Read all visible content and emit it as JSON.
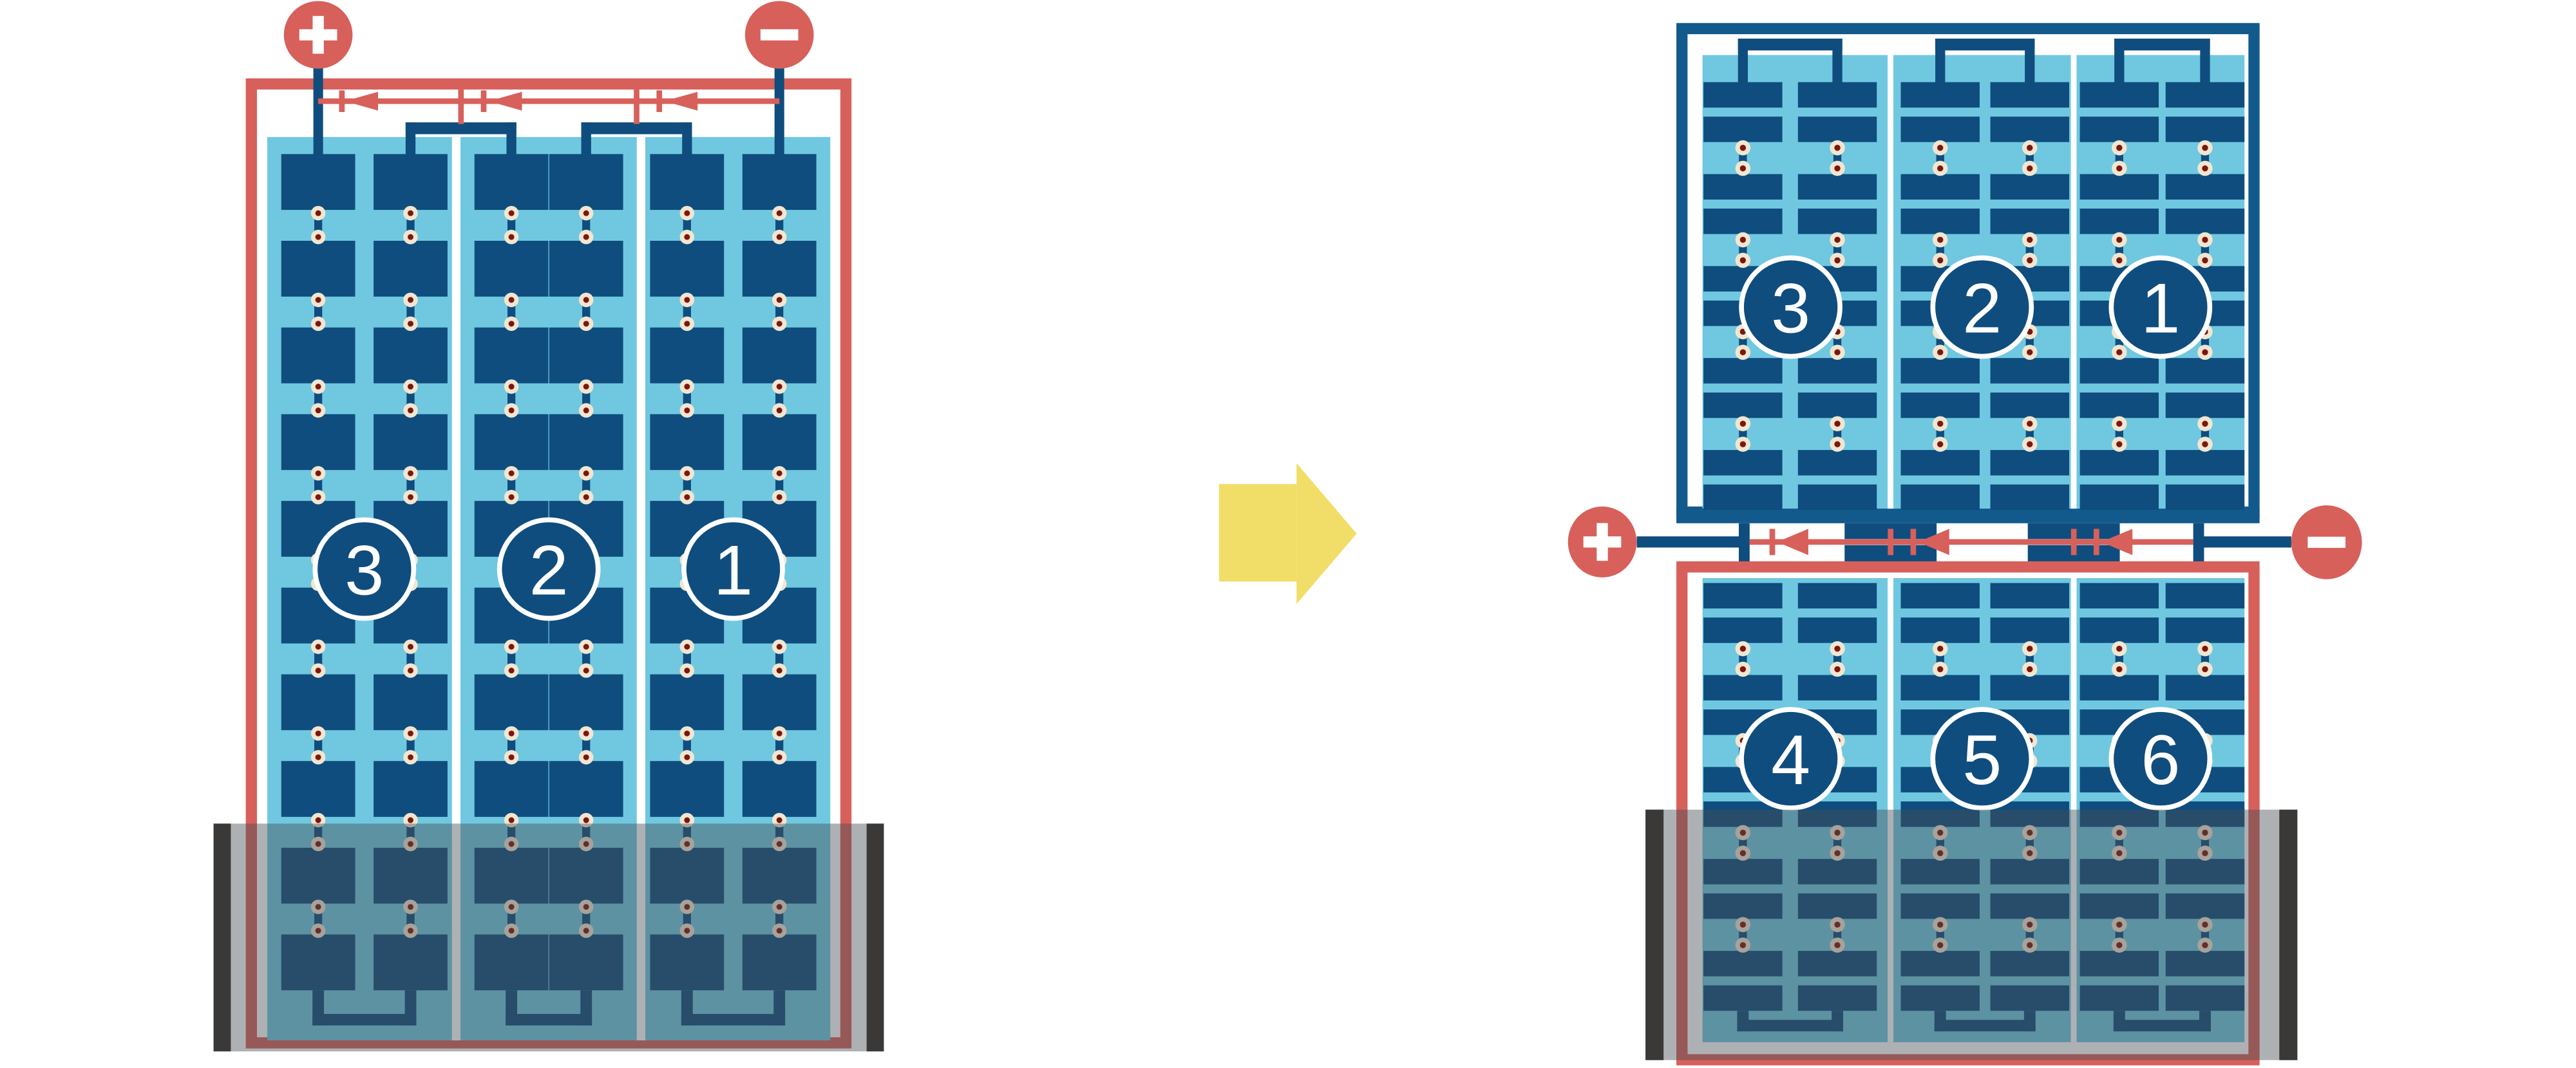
{
  "diagram_title": "",
  "terminals": {
    "positive_label": "+",
    "negative_label": "−",
    "positive_icon": "plus-icon",
    "negative_icon": "minus-icon"
  },
  "left_module": {
    "type": "full-cell-module",
    "substring_labels": [
      "3",
      "2",
      "1"
    ],
    "bypass_diode_count": 3,
    "columns": 3,
    "rows": 10,
    "shaded_bottom": true
  },
  "right_module": {
    "type": "half-cut-cell-module",
    "top_half_labels": [
      "3",
      "2",
      "1"
    ],
    "bottom_half_labels": [
      "4",
      "5",
      "6"
    ],
    "bypass_diode_count": 3,
    "columns": 3,
    "rows_per_half": 10,
    "shaded_bottom": true
  },
  "arrow": {
    "icon": "transform-arrow-icon",
    "direction": "right"
  },
  "colors": {
    "cell_navy": "#0F4D7E",
    "panel_blue": "#6FC8E0",
    "accent_red": "#D7605B",
    "frame_navy": "#135A8C",
    "solder_cream": "#F2E6D1",
    "solder_maroon": "#7D170D",
    "shade_overlay": "rgba(70,78,84,0.44)",
    "shade_bar": "#3B3938",
    "arrow_yellow": "#F1DE68",
    "white": "#FFFFFF"
  }
}
